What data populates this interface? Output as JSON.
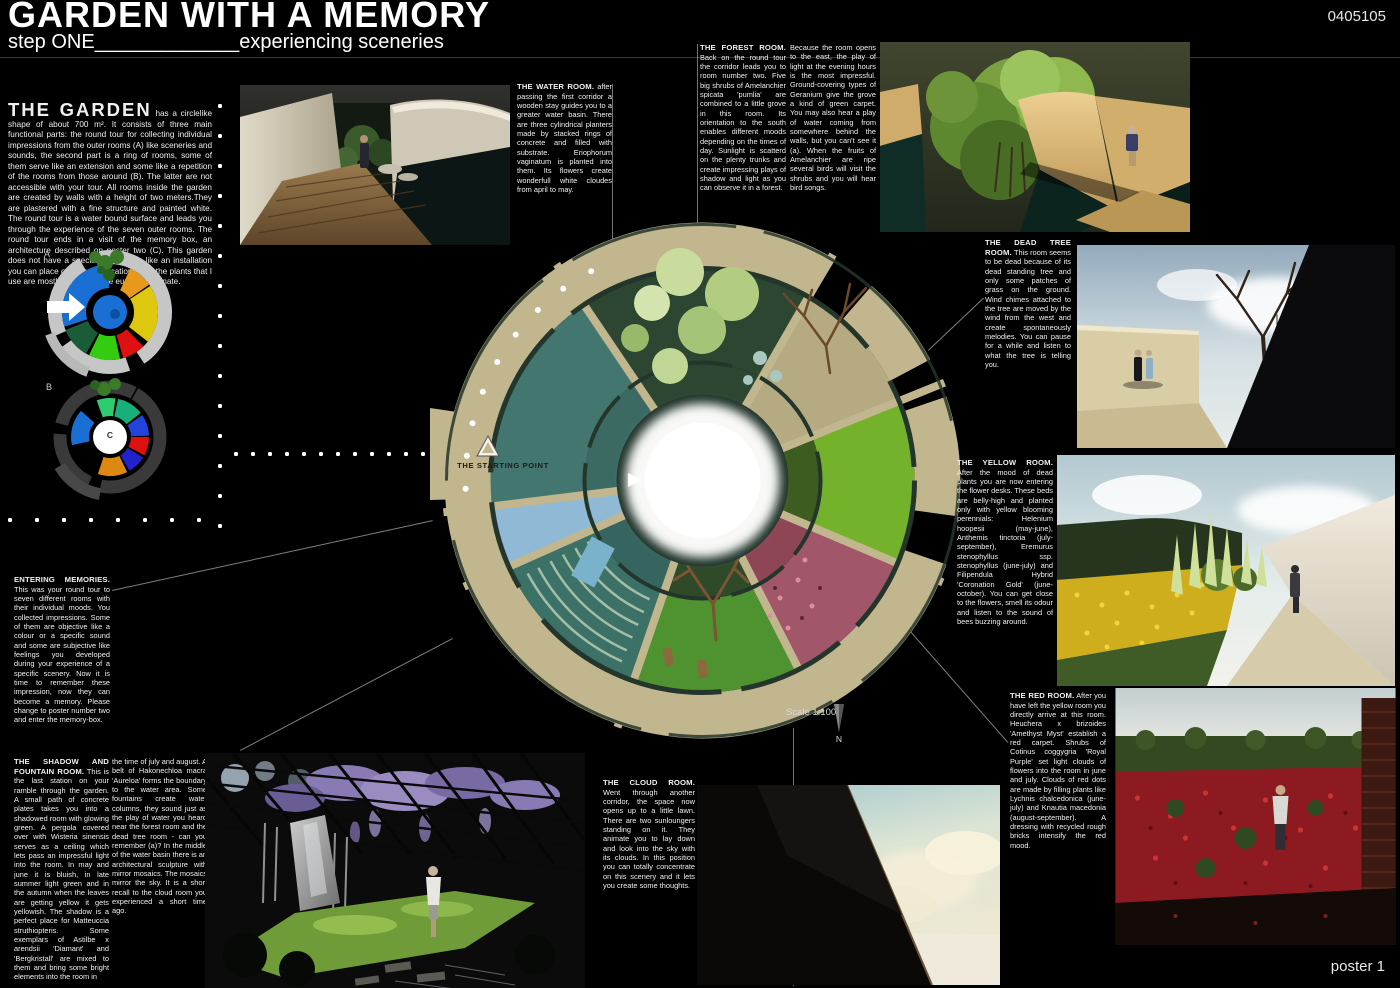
{
  "header": {
    "title": "GARDEN WITH A MEMORY",
    "subtitle": "step ONE_____________experiencing sceneries",
    "entry_number": "0405105"
  },
  "footer": {
    "poster_label": "poster 1"
  },
  "intro": {
    "heading": "THE GARDEN",
    "body": "has a circlelike shape of about 700 m². It consists of three main functional parts: the round tour for collecting individual impressions from the outer rooms (A) like sceneries and sounds, the second part is a ring of rooms, some of them serve like an extension and some like a repetition of the rooms from those around (B). The latter are not accessible with your tour. All rooms inside the garden are created by walls with a height of two meters.They are plastered with a fine structure and painted white. The round tour is a water bound surface and leads you through the experience of the seven outer rooms. The round tour ends in a visit of the memory box, an architecture described on poster two (C). This garden does not have a special location, its like an installation you can place on different locations. But the plants that I use are mostly for the middle european climate."
  },
  "diagrams": {
    "a": "A",
    "b": "B",
    "c": "C"
  },
  "plan": {
    "starting_point": "THE STARTING POINT",
    "scale": "Scale 1:100",
    "north": "N"
  },
  "rooms": {
    "water": {
      "title": "THE WATER ROOM.",
      "body": "after passing the first corridor a wooden stay guides you to a greater water basin. There are three cylindrical planters made by stacked rings of concrete and filled with substrate. Eriophorum vaginatum is planted into them. Its flowers create wonderfull white cloudes from april to may."
    },
    "forest": {
      "title": "THE FOREST ROOM.",
      "body1": "Back on the round tour the corridor leads you to room number two. Five big shrubs of Amelanchier spicata 'pumlia' are combined to a little grove in this room. Its orientation to the south enables different moods depending on the times of day. Sunlight is scatterd on the plenty trunks and create impressing plays of shadow and light as you can observe it in a forest.",
      "body2": "Because the room opens to the east, the play of light at the evening hours is the most impressful. Ground-covering types of Geranium give the grove a kind of green carpet. You may also hear a play of water coming from somewhere behind the walls, but you can't see it (a). When the fruits of Amelanchier are ripe several birds will visit the shrubs and you will hear bird songs."
    },
    "dead_tree": {
      "title": "THE DEAD TREE ROOM.",
      "body": "This room seems to be dead because of its dead standing tree and only some patches of grass on the ground. Wind chimes attached to the tree are moved by the wind from the west and create spontaneously melodies. You can pause for a while and listen to what the tree is telling you."
    },
    "yellow": {
      "title": "THE YELLOW ROOM.",
      "body": "After the mood of dead plants you are now entering the flower desks. These beds are belly-high and planted only with yellow blooming perennials: Helenium hoopesii (may-june), Anthemis tinctoria (july-september), Eremurus stenophyllus ssp. stenophyllus (june-july) and Filipendula Hybrid 'Coronation Gold' (june-october). You can get close to the flowers, smell its odour and listen to the sound of bees buzzing around."
    },
    "red": {
      "title": "THE RED ROOM.",
      "body": "After you have left the yellow room you directly arrive at this room. Heuchera x brizoides 'Amethyst Myst' establish a red carpet. Shrubs of Cotinus coggygria 'Royal Purple' set light clouds of flowers into the room in june and july. Clouds of red dots are made by filling plants like Lychnis chalcedonica (june-july) and Knautia macedonia (august-september). A dressing with recycled rough bricks intensify the red mood."
    },
    "cloud": {
      "title": "THE CLOUD ROOM.",
      "body": "Went through another corridor, the space now opens up to a little lawn. There are two sunloungers standing on it. They animate you to lay down and look into the sky with its clouds. In this position you can totally concentrate on this scenery and it lets you create some thoughts."
    },
    "shadow": {
      "title": "THE SHADOW AND FOUNTAIN ROOM.",
      "body1": "This is the last station on your ramble through the garden. A small path of concrete plates takes you into a shadowed room with glowing green. A pergola covered over with Wisteria sinensis serves as a ceiling which lets pass an impressful light into the room. In may and june it is bluish, in late summer light green and in the autumn when the leaves are getting yellow it gets yellowish. The shadow is a perfect place for Matteuccia struthiopteris. Some exemplars of Astilbe x arendsii 'Diamant' and 'Bergkristall' are mixed to them and bring some bright elements into the room in",
      "body2": "the time of july and august. A belt of Hakonechloa macra 'Aureloa' forms the boundary to the water area. Some fountains create water columns, they sound just as the play of water you heard near the forest room and the dead tree room - can you remember (a)? In the middle of the water basin there is an architectural sculpture with mirror mosaics. The mosaics mirror the sky. It is a short recall to the cloud room you experienced a short time ago."
    },
    "memories": {
      "title": "ENTERING MEMORIES.",
      "body": "This was your round tour to seven different rooms with their individual moods. You collected impressions. Some of them are objective like a colour or a specific sound and some are subjective like feelings you developed during your experience of a specific scenery. Now it is time to remember these impression, now they can become a memory. Please change to poster number two and enter the memory-box."
    }
  },
  "palette": {
    "background": "#000000",
    "text": "#ffffff",
    "plan_path_tan": "#c2b68e",
    "plan_wall_green": "#24362b",
    "water_teal": "#42766f",
    "lawn_green": "#4f9230",
    "flower_pink": "#a2566a",
    "hedge_bright_green": "#74b22c",
    "diagram_blue": "#1a6fd4",
    "diagram_yellow": "#ddc70f",
    "diagram_red": "#dd1111",
    "diagram_orange": "#e8981a"
  }
}
